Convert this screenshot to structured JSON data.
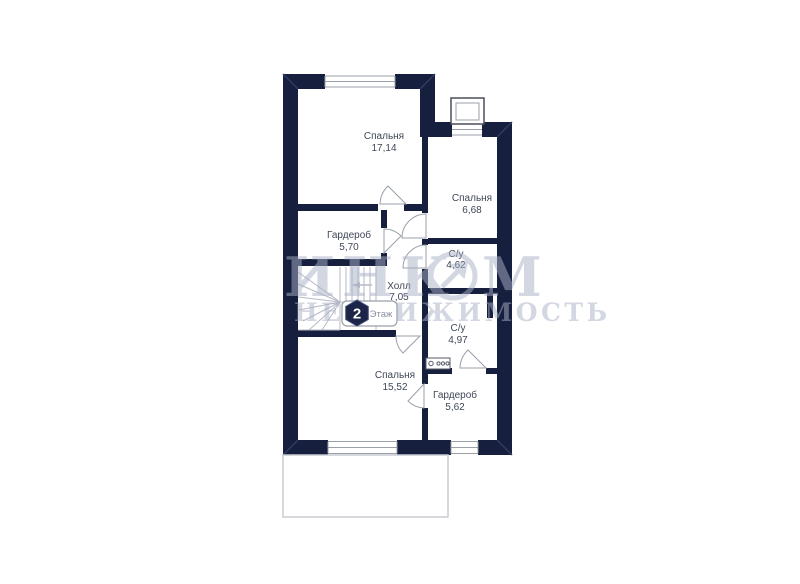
{
  "plan": {
    "floor_badge": {
      "number": "2",
      "label": "Этаж"
    },
    "watermark": {
      "word_part1": "ИНК",
      "word_part2": "М",
      "line2": "НЕДВИЖИМОСТЬ"
    },
    "rooms": [
      {
        "name": "Спальня",
        "area": "17,14"
      },
      {
        "name": "Спальня",
        "area": "6,68"
      },
      {
        "name": "Гардероб",
        "area": "5,70"
      },
      {
        "name": "Холл",
        "area": "7,05"
      },
      {
        "name": "С/у",
        "area": "4,62"
      },
      {
        "name": "С/у",
        "area": "4,97"
      },
      {
        "name": "Спальня",
        "area": "15,52"
      },
      {
        "name": "Гардероб",
        "area": "5,62"
      }
    ],
    "colors": {
      "wall": "#16203e",
      "room_label": "#3f4757",
      "watermark": "#a9b0c7",
      "badge_hexagon": "#1c2547"
    }
  }
}
